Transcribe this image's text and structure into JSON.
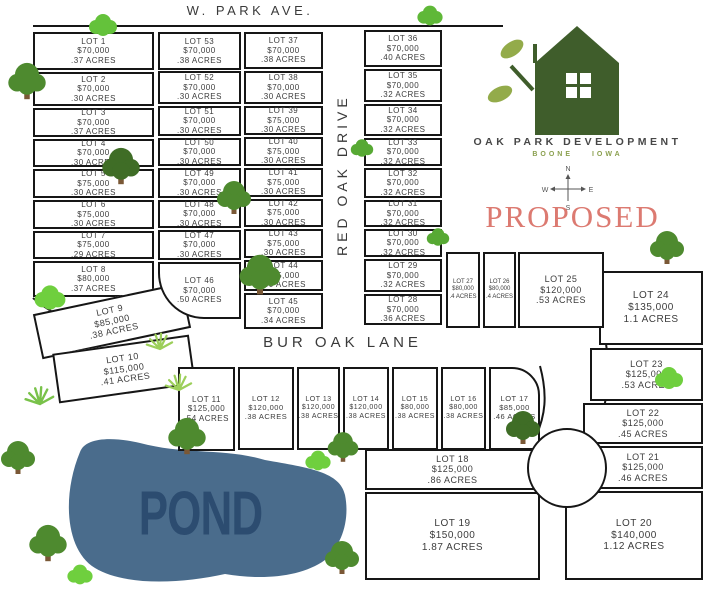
{
  "streets": {
    "top": "W. PARK AVE.",
    "vertical": "RED OAK DRIVE",
    "lane": "BUR OAK LANE"
  },
  "pond": {
    "label": "POND"
  },
  "proposed": {
    "label": "PROPOSED"
  },
  "logo": {
    "title": "OAK PARK DEVELOPMENT",
    "subtitle": "BOONE IOWA"
  },
  "compass": {
    "north": "N",
    "east": "E",
    "south": "S",
    "west": "W"
  },
  "colors": {
    "pond_fill": "#4a6c8c",
    "pond_text": "#2c4c70",
    "house_green": "#3f5d2b",
    "leaf_olive": "#93ab4a",
    "proposed_red": "#dc7a71",
    "line_black": "#161616"
  },
  "lots": [
    {
      "label": "LOT 1",
      "price": "$70,000",
      "acres": ".37 ACRES"
    },
    {
      "label": "LOT 2",
      "price": "$70,000",
      "acres": ".30 ACRES"
    },
    {
      "label": "LOT 3",
      "price": "$70,000",
      "acres": ".37 ACRES"
    },
    {
      "label": "LOT 4",
      "price": "$70,000",
      "acres": ".30 ACRES"
    },
    {
      "label": "LOT 5",
      "price": "$75,000",
      "acres": ".30 ACRES"
    },
    {
      "label": "LOT 6",
      "price": "$75,000",
      "acres": ".30 ACRES"
    },
    {
      "label": "LOT 7",
      "price": "$75,000",
      "acres": ".29 ACRES"
    },
    {
      "label": "LOT 8",
      "price": "$80,000",
      "acres": ".37 ACRES"
    },
    {
      "label": "LOT 9",
      "price": "$85,000",
      "acres": ".38 ACRES"
    },
    {
      "label": "LOT 10",
      "price": "$115,000",
      "acres": ".41 ACRES"
    },
    {
      "label": "LOT 11",
      "price": "$125,000",
      "acres": ".54 ACRES"
    },
    {
      "label": "LOT 12",
      "price": "$120,000",
      "acres": ".38 ACRES"
    },
    {
      "label": "LOT 13",
      "price": "$120,000",
      "acres": ".38 ACRES"
    },
    {
      "label": "LOT 14",
      "price": "$120,000",
      "acres": ".38 ACRES"
    },
    {
      "label": "LOT 15",
      "price": "$80,000",
      "acres": ".38 ACRES"
    },
    {
      "label": "LOT 16",
      "price": "$80,000",
      "acres": ".38 ACRES"
    },
    {
      "label": "LOT 17",
      "price": "$85,000",
      "acres": ".46 ACRES"
    },
    {
      "label": "LOT 18",
      "price": "$125,000",
      "acres": ".86 ACRES"
    },
    {
      "label": "LOT 19",
      "price": "$150,000",
      "acres": "1.87 ACRES"
    },
    {
      "label": "LOT 20",
      "price": "$140,000",
      "acres": "1.12 ACRES"
    },
    {
      "label": "LOT 21",
      "price": "$125,000",
      "acres": ".46 ACRES"
    },
    {
      "label": "LOT 22",
      "price": "$125,000",
      "acres": ".45 ACRES"
    },
    {
      "label": "LOT 23",
      "price": "$125,000",
      "acres": ".53 ACRES"
    },
    {
      "label": "LOT 24",
      "price": "$135,000",
      "acres": "1.1 ACRES"
    },
    {
      "label": "LOT 25",
      "price": "$120,000",
      "acres": ".53 ACRES"
    },
    {
      "label": "LOT 26",
      "price": "$80,000",
      "acres": ".4 ACRES"
    },
    {
      "label": "LOT 27",
      "price": "$80,000",
      "acres": ".4 ACRES"
    },
    {
      "label": "LOT 28",
      "price": "$70,000",
      "acres": ".36 ACRES"
    },
    {
      "label": "LOT 29",
      "price": "$70,000",
      "acres": ".32 ACRES"
    },
    {
      "label": "LOT 30",
      "price": "$70,000",
      "acres": ".32 ACRES"
    },
    {
      "label": "LOT 31",
      "price": "$70,000",
      "acres": ".32 ACRES"
    },
    {
      "label": "LOT 32",
      "price": "$70,000",
      "acres": ".32 ACRES"
    },
    {
      "label": "LOT 33",
      "price": "$70,000",
      "acres": ".32 ACRES"
    },
    {
      "label": "LOT 34",
      "price": "$70,000",
      "acres": ".32 ACRES"
    },
    {
      "label": "LOT 35",
      "price": "$70,000",
      "acres": ".32 ACRES"
    },
    {
      "label": "LOT 36",
      "price": "$70,000",
      "acres": ".40 ACRES"
    },
    {
      "label": "LOT 37",
      "price": "$70,000",
      "acres": ".38 ACRES"
    },
    {
      "label": "LOT 38",
      "price": "$70,000",
      "acres": ".30 ACRES"
    },
    {
      "label": "LOT 39",
      "price": "$75,000",
      "acres": ".30 ACRES"
    },
    {
      "label": "LOT 40",
      "price": "$75,000",
      "acres": ".30 ACRES"
    },
    {
      "label": "LOT 41",
      "price": "$75,000",
      "acres": ".30 ACRES"
    },
    {
      "label": "LOT 42",
      "price": "$75,000",
      "acres": ".30 ACRES"
    },
    {
      "label": "LOT 43",
      "price": "$75,000",
      "acres": ".30 ACRES"
    },
    {
      "label": "LOT 44",
      "price": "$75,000",
      "acres": ".30 ACRES"
    },
    {
      "label": "LOT 45",
      "price": "$70,000",
      "acres": ".34 ACRES"
    },
    {
      "label": "LOT 46",
      "price": "$70,000",
      "acres": ".50 ACRES"
    },
    {
      "label": "LOT 47",
      "price": "$70,000",
      "acres": ".30 ACRES"
    },
    {
      "label": "LOT 48",
      "price": "$70,000",
      "acres": ".30 ACRES"
    },
    {
      "label": "LOT 49",
      "price": "$70,000",
      "acres": ".30 ACRES"
    },
    {
      "label": "LOT 50",
      "price": "$70,000",
      "acres": ".30 ACRES"
    },
    {
      "label": "LOT 51",
      "price": "$70,000",
      "acres": ".30 ACRES"
    },
    {
      "label": "LOT 52",
      "price": "$70,000",
      "acres": ".30 ACRES"
    },
    {
      "label": "LOT 53",
      "price": "$70,000",
      "acres": ".38 ACRES"
    }
  ]
}
